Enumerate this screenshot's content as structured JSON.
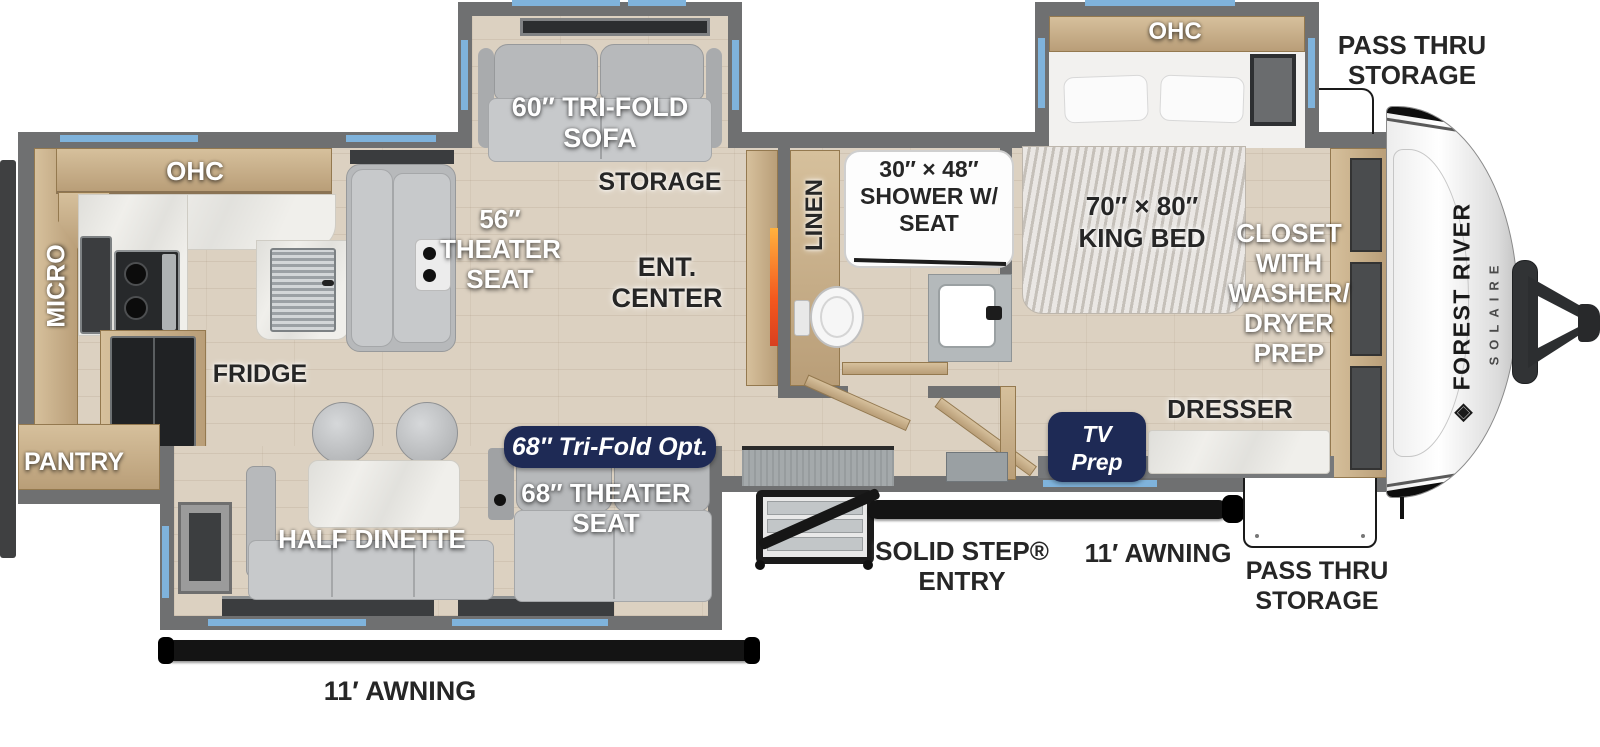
{
  "page": {
    "description": "Top-down RV travel trailer floor plan"
  },
  "brand": {
    "manufacturer": "FOREST RIVER",
    "model": "SOLAIRE"
  },
  "icons": {
    "brand_diamond": "◈"
  },
  "colors": {
    "window_blue": "#7fb3dc",
    "badge_navy": "#1e2a55",
    "wall_gray": "#6f7071",
    "wood_tan": "#c9b28e",
    "awning_black": "#141414",
    "fireplace_orange": "#f4581e"
  },
  "labels": {
    "kitchen_ohc": "OHC",
    "micro": "MICRO",
    "pantry": "PANTRY",
    "fridge": "FRIDGE",
    "theater_56": [
      "56″",
      "THEATER",
      "SEAT"
    ],
    "trifold_sofa": [
      "60″ TRI-FOLD",
      "SOFA"
    ],
    "storage": "STORAGE",
    "ent_center": [
      "ENT.",
      "CENTER"
    ],
    "trifold_opt_badge": "68″ Tri-Fold Opt.",
    "half_dinette": "HALF DINETTE",
    "theater_68": [
      "68″ THEATER",
      "SEAT"
    ],
    "awning_rear": "11′ AWNING",
    "linen": "LINEN",
    "shower": [
      "30″ × 48″",
      "SHOWER W/",
      "SEAT"
    ],
    "bed_ohc": "OHC",
    "king_bed": [
      "70″ × 80″",
      "KING BED"
    ],
    "closet": [
      "CLOSET",
      "WITH",
      "WASHER/",
      "DRYER",
      "PREP"
    ],
    "dresser": "DRESSER",
    "tv_prep_badge": [
      "TV",
      "Prep"
    ],
    "solid_step": [
      "SOLID STEP®",
      "ENTRY"
    ],
    "awning_entry": "11′ AWNING",
    "pass_thru_top": [
      "PASS THRU",
      "STORAGE"
    ],
    "pass_thru_bottom": [
      "PASS THRU",
      "STORAGE"
    ]
  }
}
